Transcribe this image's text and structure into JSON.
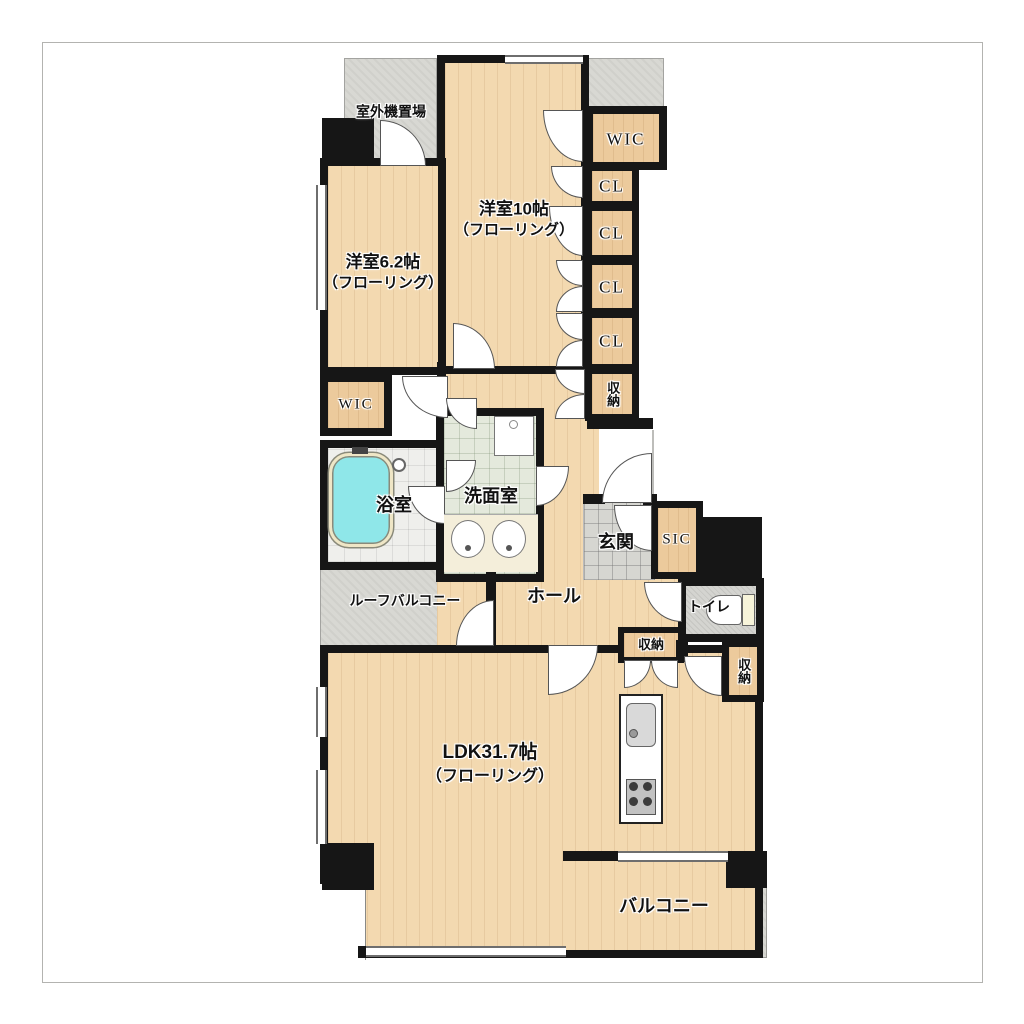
{
  "rooms": {
    "outdoor_unit": {
      "label": "室外機置場"
    },
    "bedroom10": {
      "label": "洋室10帖",
      "sublabel": "（フローリング）"
    },
    "bedroom62": {
      "label": "洋室6.2帖",
      "sublabel": "（フローリング）"
    },
    "wic_top": {
      "label": "WIC"
    },
    "cl1": {
      "label": "CL"
    },
    "cl2": {
      "label": "CL"
    },
    "cl3": {
      "label": "CL"
    },
    "cl4": {
      "label": "CL"
    },
    "storage_upper": {
      "label": "収納"
    },
    "wic_left": {
      "label": "WIC"
    },
    "bathroom": {
      "label": "浴室"
    },
    "washroom": {
      "label": "洗面室"
    },
    "entrance": {
      "label": "玄関"
    },
    "sic": {
      "label": "SIC"
    },
    "toilet": {
      "label": "トイレ"
    },
    "hall": {
      "label": "ホール"
    },
    "roof_balcony": {
      "label": "ルーフバルコニー"
    },
    "storage_hall": {
      "label": "収納"
    },
    "storage_ldk": {
      "label": "収納"
    },
    "ldk": {
      "label": "LDK31.7帖",
      "sublabel": "（フローリング）"
    },
    "balcony": {
      "label": "バルコニー"
    }
  },
  "colors": {
    "wall": "#161616",
    "wood_floor": "#f3d9b0",
    "closet_wood": "#ecca9c",
    "outdoor_gray": "#d8d8d3",
    "washroom_green": "#e4e9dc",
    "bathtub_cyan": "#8fe7e9",
    "toilet_tank_cream": "#f7f4da"
  }
}
